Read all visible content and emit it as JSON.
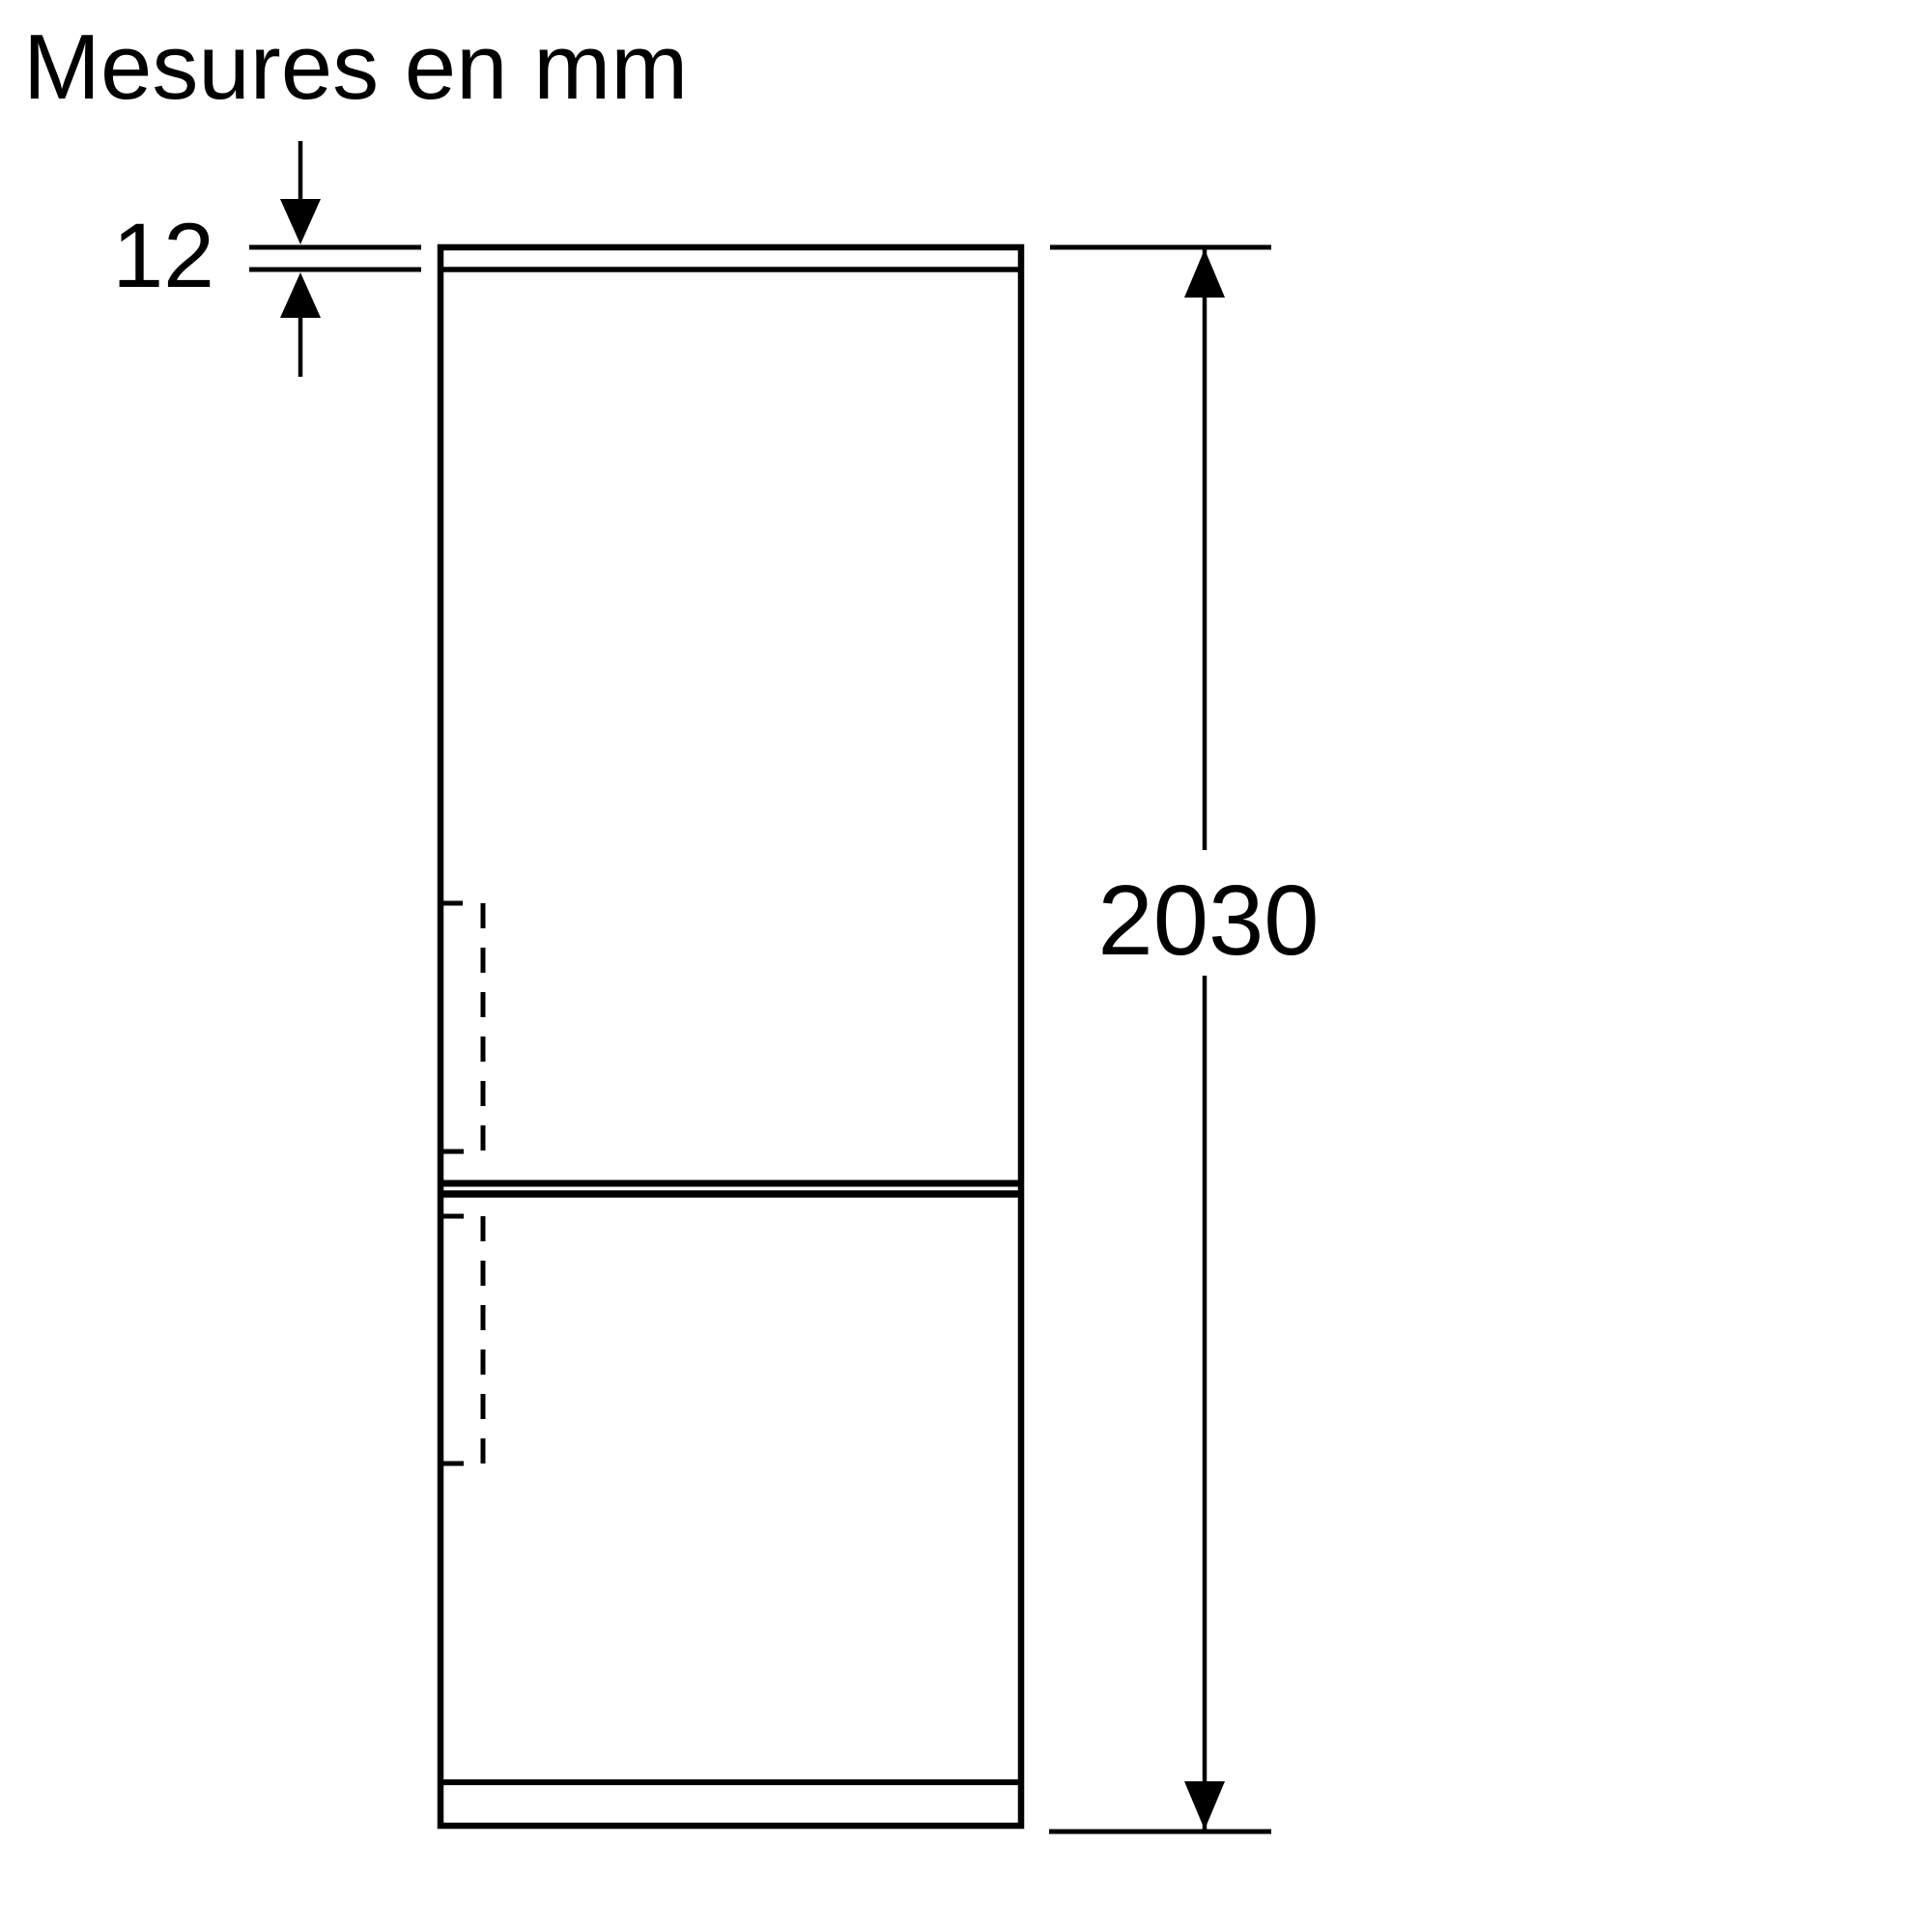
{
  "title": "Mesures en mm",
  "colors": {
    "line": "#000000",
    "text": "#000000",
    "background": "#ffffff"
  },
  "dimensions": {
    "thickness": {
      "label": "12"
    },
    "height": {
      "label": "2030"
    }
  }
}
